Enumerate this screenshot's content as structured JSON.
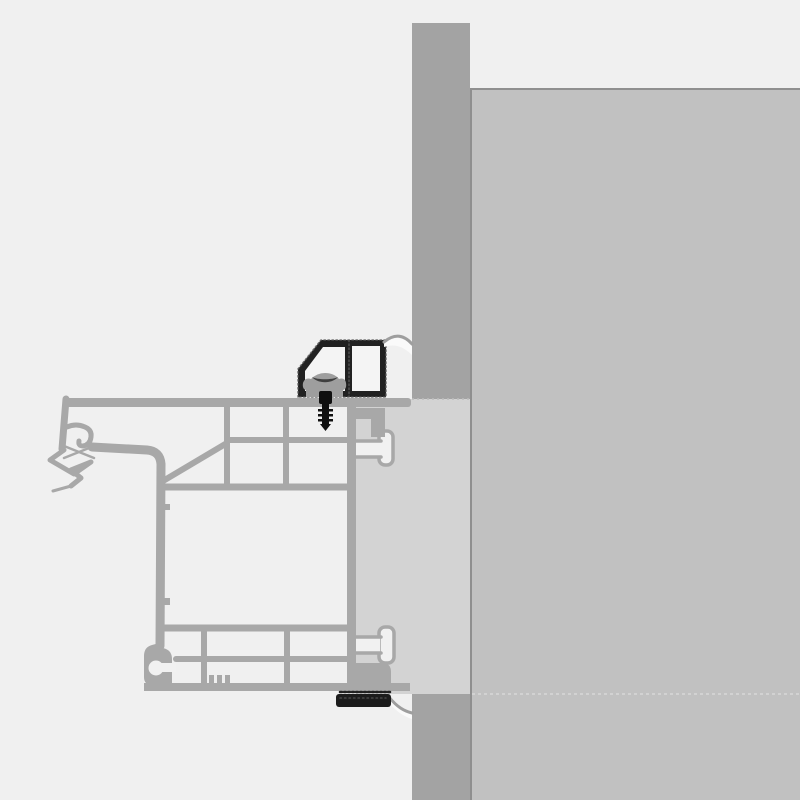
{
  "figure": {
    "kind": "technical-cross-section",
    "subject": "window-frame-to-wall-installation-detail",
    "orientation": "horizontal-section, frame at left, masonry wall at right"
  },
  "colors": {
    "background": "#f0f0f0",
    "wall_section": "#a3a3a3",
    "wall_interior": "#c1c1c1",
    "wall_interior_border": "#8f8f8f",
    "wall_seam": "#d8d8d8",
    "frame_block": "#d3d3d3",
    "block_edge": "#bdbdbd",
    "profile": "#a8a8a8",
    "cell_fill": "#f1f1f1",
    "seal_profile": "#212121",
    "seal_texture": "#5a5a5a",
    "seal_cell": "#f4f4f4",
    "clip": "#9e9e9e",
    "clip_notch": "#3f3f3f",
    "screw": "#101010",
    "membrane_fill": "#fafafa",
    "membrane_edge": "#9e9e9e",
    "bottom_seal": "#1c1c1c"
  },
  "parts": {
    "wall_section_label": "masonry wall section (cut)",
    "wall_interior_label": "interior wall face / reveal",
    "frame_label": "multi-chamber window frame profile",
    "block_label": "frame extension block in wall opening",
    "seal_label": "clamping seal profile (hatched, black)",
    "clip_label": "fixing clip / washer plate",
    "screw_label": "fixing screw",
    "membrane_top_label": "sealing membrane swoosh (top)",
    "membrane_bottom_label": "sealing membrane swoosh (bottom)",
    "bottom_seal_label": "compression seal strip (bottom)",
    "gasket_label": "co-extruded gasket (X)",
    "drip_label": "drip / weatherboard lip",
    "anchor_top_label": "T-anchor channel (top)",
    "anchor_bottom_label": "T-anchor channel (bottom)"
  }
}
